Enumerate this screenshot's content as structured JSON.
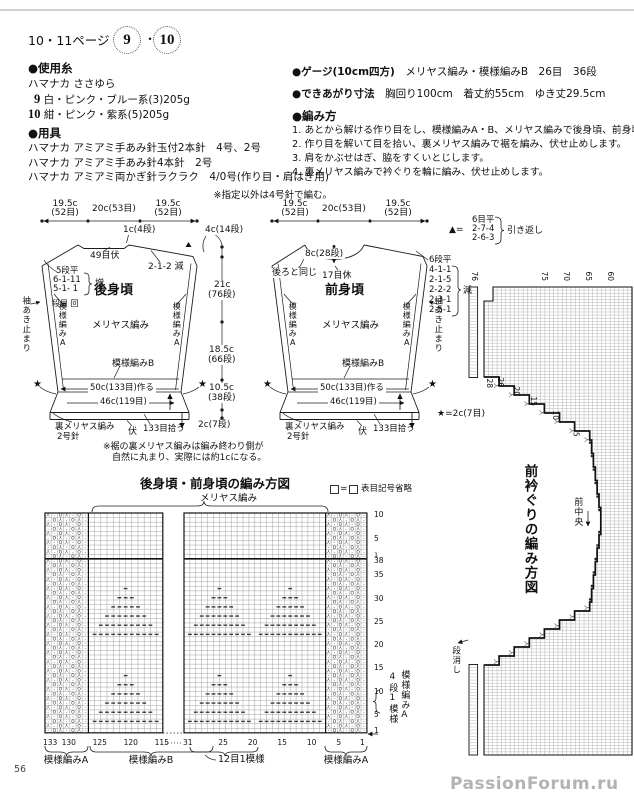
{
  "page": {
    "top_note": "※指定以外は4号針で編む。",
    "number": "56",
    "watermark": "PassionForum.ru"
  },
  "header": {
    "page_ref": "10・11ページ",
    "item1": "9",
    "sep": "・",
    "item2": "10"
  },
  "materials": {
    "title": "●使用糸",
    "brand": "ハマナカ ささゆら",
    "items": [
      {
        "num": "9",
        "desc": "白・ピンク・ブルー系(3)205g"
      },
      {
        "num": "10",
        "desc": "紺・ピンク・紫系(5)205g"
      }
    ]
  },
  "tools": {
    "title": "●用具",
    "items": [
      "ハマナカ アミアミ手あみ針玉付2本針　4号、2号",
      "ハマナカ アミアミ手あみ針4本針　2号",
      "ハマナカ アミアミ両かぎ針ラクラク　4/0号(作り目・肩はぎ用)"
    ]
  },
  "gauge": {
    "title": "●ゲージ(10cm四方)",
    "value": "メリヤス編み・模様編みB　26目　36段"
  },
  "finished": {
    "title": "●できあがり寸法",
    "value": "胸回り100cm　着丈約55cm　ゆき丈29.5cm"
  },
  "howto": {
    "title": "●編み方",
    "steps": [
      "1. あとから解ける作り目をし、模様編みA・B、メリヤス編みで後身頃、前身頃を編みます。",
      "2. 作り目を解いて目を拾い、裏メリヤス編みで裾を編み、伏せ止めします。",
      "3. 肩をかぶせはぎ、脇をすくいとじします。",
      "4. 裏メリヤス編みで衿ぐりを輪に編み、伏せ止めします。"
    ]
  },
  "schematic": {
    "back": {
      "name": "後身頃",
      "width_l": "19.5c",
      "width_l2": "(52目)",
      "width_c": "20c(53目)",
      "width_r": "19.5c",
      "width_r2": "(52目)",
      "neck": "1c(4段)",
      "bindoff": "49目伏",
      "dec": "2-1-2 減",
      "inc": [
        "5段平",
        "6-1-11",
        "5-1- 1"
      ],
      "inc_mark": "増",
      "inc_note": "段目 回"
    },
    "front": {
      "name": "前身頃",
      "width_l": "19.5c",
      "width_l2": "(52目)",
      "width_c": "20c(53目)",
      "width_r": "19.5c",
      "width_r2": "(52目)",
      "neck_depth": "8c(28段)",
      "hold": "17目休",
      "same": "後ろと同じ",
      "dec": [
        "6段平",
        "4-1-1",
        "2-1-5",
        "2-2-2",
        "2-3-1",
        "2-5-1"
      ],
      "dec_mark": "減"
    },
    "common": {
      "pattern_a": "模様編みA",
      "stockinette": "メリヤス編み",
      "pattern_b": "模様編みB",
      "cast_on": "50c(133目)作る",
      "hem_width": "46c(119目)",
      "rev_st": "裏メリヤス編み",
      "needle2": "2号針",
      "bind_off": "伏",
      "pickup": "133目拾う",
      "sleeve_stop": "袖あき止まり",
      "star": "★"
    },
    "center": [
      "4c(14段)",
      "21c",
      "(76段)",
      "18.5c",
      "(66段)",
      "10.5c",
      "(38段)",
      "2c(7段)"
    ],
    "turn_legend": {
      "sym": "▲=",
      "rows": [
        "6目平",
        "2-7-4",
        "2-6-3"
      ],
      "label": "引き返し"
    },
    "star_legend": "★=2c(7目)",
    "hem_note1": "※裾の裏メリヤス編みは編み終わり側が",
    "hem_note2": "自然に丸まり、実際には約1cになる。"
  },
  "neck_chart": {
    "title": "前衿ぐりの編み方図",
    "front_center": "前中央",
    "erase": "段消し",
    "top_numbers": [
      "76",
      "75",
      "70",
      "65",
      "60"
    ],
    "step_numbers": [
      "28",
      "26",
      "20",
      "15",
      "10",
      "5"
    ],
    "symbols": {
      "dec": "人"
    }
  },
  "bottom_chart": {
    "title": "後身頃・前身頃の編み方図",
    "legend_eq": "=",
    "legend_text": "表目記号省略",
    "stockinette": "メリヤス編み",
    "pattern_a_left": "模様編みA",
    "pattern_b": "模様編みB",
    "repeat": "12目1模様",
    "pattern_a_right": "模様編みA",
    "side_repeat": "4段1模様",
    "side_pattern": "模様編みA",
    "row_numbers_upper": [
      "10",
      "5",
      "1"
    ],
    "row_numbers_lower": [
      "38",
      "35",
      "30",
      "25",
      "20",
      "15",
      "10",
      "5",
      "1"
    ],
    "col_numbers_left": [
      "133",
      "130",
      "125",
      "120",
      "115"
    ],
    "col_numbers_right": [
      "31",
      "25",
      "20",
      "15",
      "10",
      "5",
      "1"
    ],
    "symbols": {
      "dec": "人",
      "purl": "-",
      "yo": "O"
    }
  }
}
